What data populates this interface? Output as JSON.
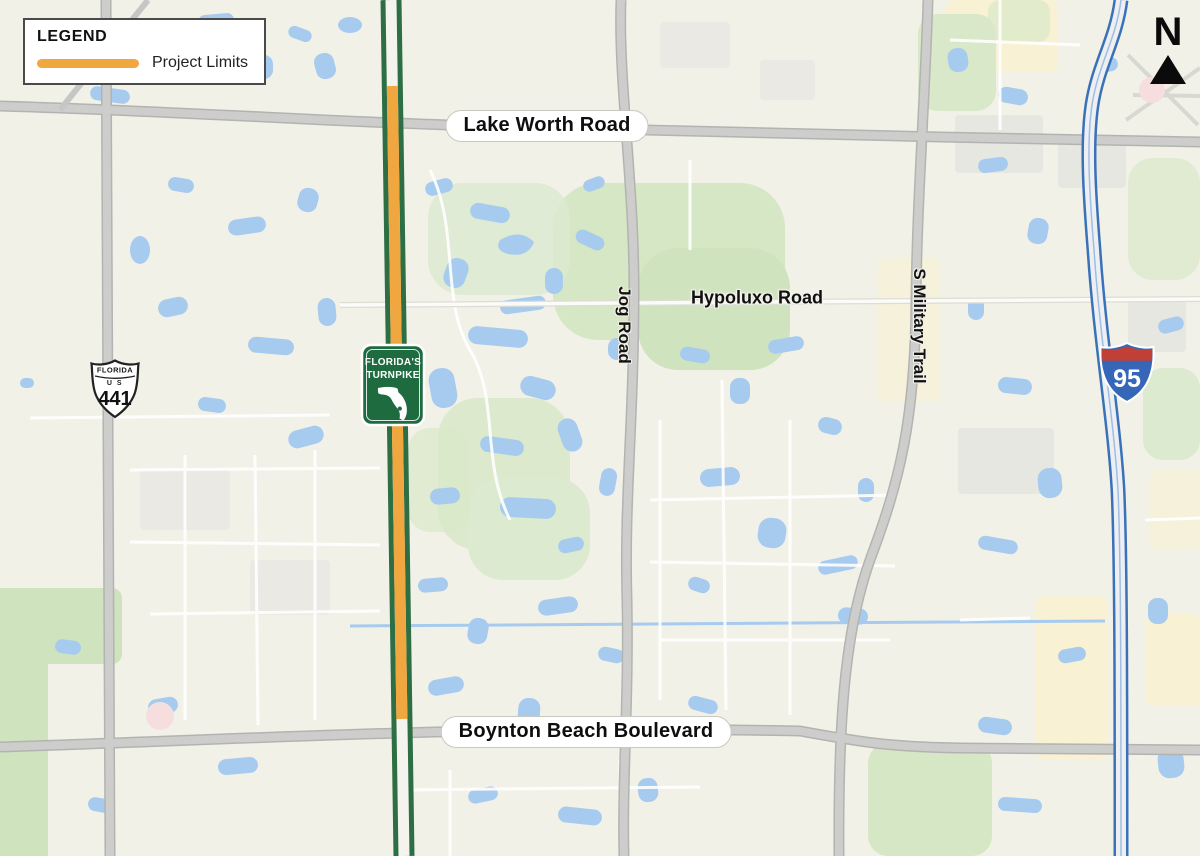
{
  "legend": {
    "title": "LEGEND",
    "items": [
      {
        "label": "Project Limits",
        "color": "#F0A73F"
      }
    ]
  },
  "north_arrow": {
    "label": "N"
  },
  "map": {
    "road_labels": {
      "lake_worth": "Lake Worth Road",
      "hypoluxo": "Hypoluxo Road",
      "boynton": "Boynton Beach Boulevard",
      "jog": "Jog Road",
      "military": "S Military Trail"
    },
    "shields": {
      "turnpike": {
        "line1": "FLORIDA'S",
        "line2": "TURNPIKE"
      },
      "us441": {
        "state": "FLORIDA",
        "us": "U S",
        "number": "441"
      },
      "i95": {
        "number": "95"
      }
    },
    "colors": {
      "project_limits": "#F0A73F",
      "turnpike_green": "#2E6E44",
      "interstate_blue": "#3A72B8",
      "interstate_red": "#C04038",
      "water": "#A6CBEF",
      "park_green": "#D5E7C4",
      "road_gray": "#CDCDCB",
      "background": "#F2F1E8"
    }
  }
}
